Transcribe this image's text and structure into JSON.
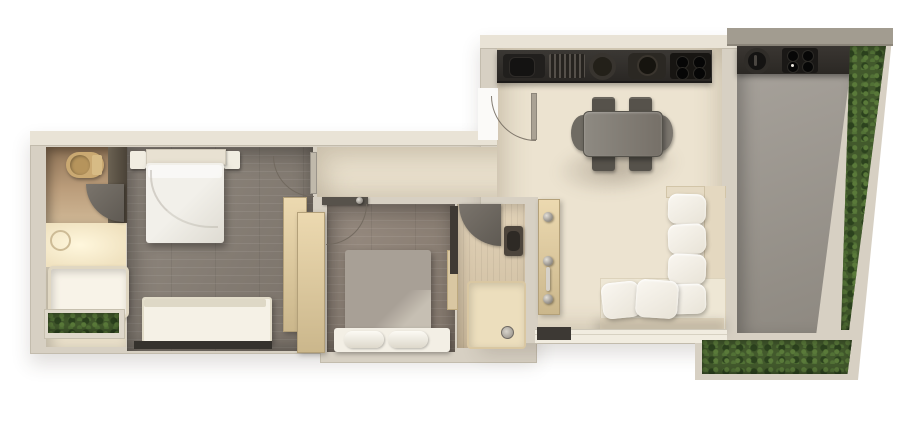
{
  "scene": {
    "description": "3D top-down architectural floor-plan render of an apartment with two bedrooms, two bathrooms, open living-kitchen and a planted balcony terrace",
    "view": "top-down",
    "background_color": "#ffffff",
    "visible_text": ""
  },
  "palette": {
    "outer_wall": "#d7d0c3",
    "wall_highlight": "#e9e3d6",
    "living_floor_cream": "#ece3d0",
    "bedroom_plank_floor": "#877e74",
    "bathroom1_glass_brown": "#bb9d7b",
    "bathroom2_wood_floor": "#dcc9a9",
    "wardrobe_wood": "#ecd9b0",
    "kitchen_counter_dark": "#2a2724",
    "appliance_black": "#171512",
    "balcony_floor_grey": "#9c978e",
    "hedge_green": "#42592c",
    "sofa_cushion_white": "#faf7f1",
    "sofa_frame_beige": "#e4d8c0",
    "bed2_blanket_grey": "#a8a096",
    "dining_table_grey": "#85817a",
    "dining_chair_grey": "#56524b",
    "door_leaf_grey": "#6e6963",
    "toilet_gold": "#caa972",
    "shower_glow": "#fff7dd",
    "window_frame_dark": "#35322d"
  },
  "rooms": [
    {
      "id": "bathroom-1",
      "furniture": [
        "toilet",
        "swing-door",
        "shower",
        "shower-head",
        "bathtub",
        "planter-hedge"
      ]
    },
    {
      "id": "bedroom-1",
      "furniture": [
        "headboard",
        "double-bed",
        "nightstand-left",
        "nightstand-right",
        "upholstered-bench",
        "window",
        "swing-door"
      ]
    },
    {
      "id": "hallway",
      "furniture": [
        "wardrobe-panel-a",
        "wardrobe-panel-b"
      ]
    },
    {
      "id": "bedroom-2",
      "furniture": [
        "double-bed-grey",
        "rolled-pillows",
        "side-shelf",
        "swing-door"
      ]
    },
    {
      "id": "bathroom-2",
      "furniture": [
        "swing-door",
        "door-leaf",
        "washbasin",
        "shower-tray",
        "floor-drain"
      ]
    },
    {
      "id": "living-kitchen",
      "furniture": [
        "kitchen-counter",
        "sink",
        "dish-drainer",
        "round-burner",
        "pot-station",
        "four-burner-hob",
        "entry-door",
        "dining-table",
        "dining-chair-x4",
        "end-chair-x2",
        "coat-panel-with-knobs",
        "corner-sofa",
        "back-cushions-x4",
        "seat-pillows-x2",
        "window-sill"
      ]
    },
    {
      "id": "balcony",
      "furniture": [
        "outdoor-counter",
        "grill",
        "outdoor-hob",
        "hedge-right",
        "hedge-planter-bottom"
      ]
    }
  ]
}
